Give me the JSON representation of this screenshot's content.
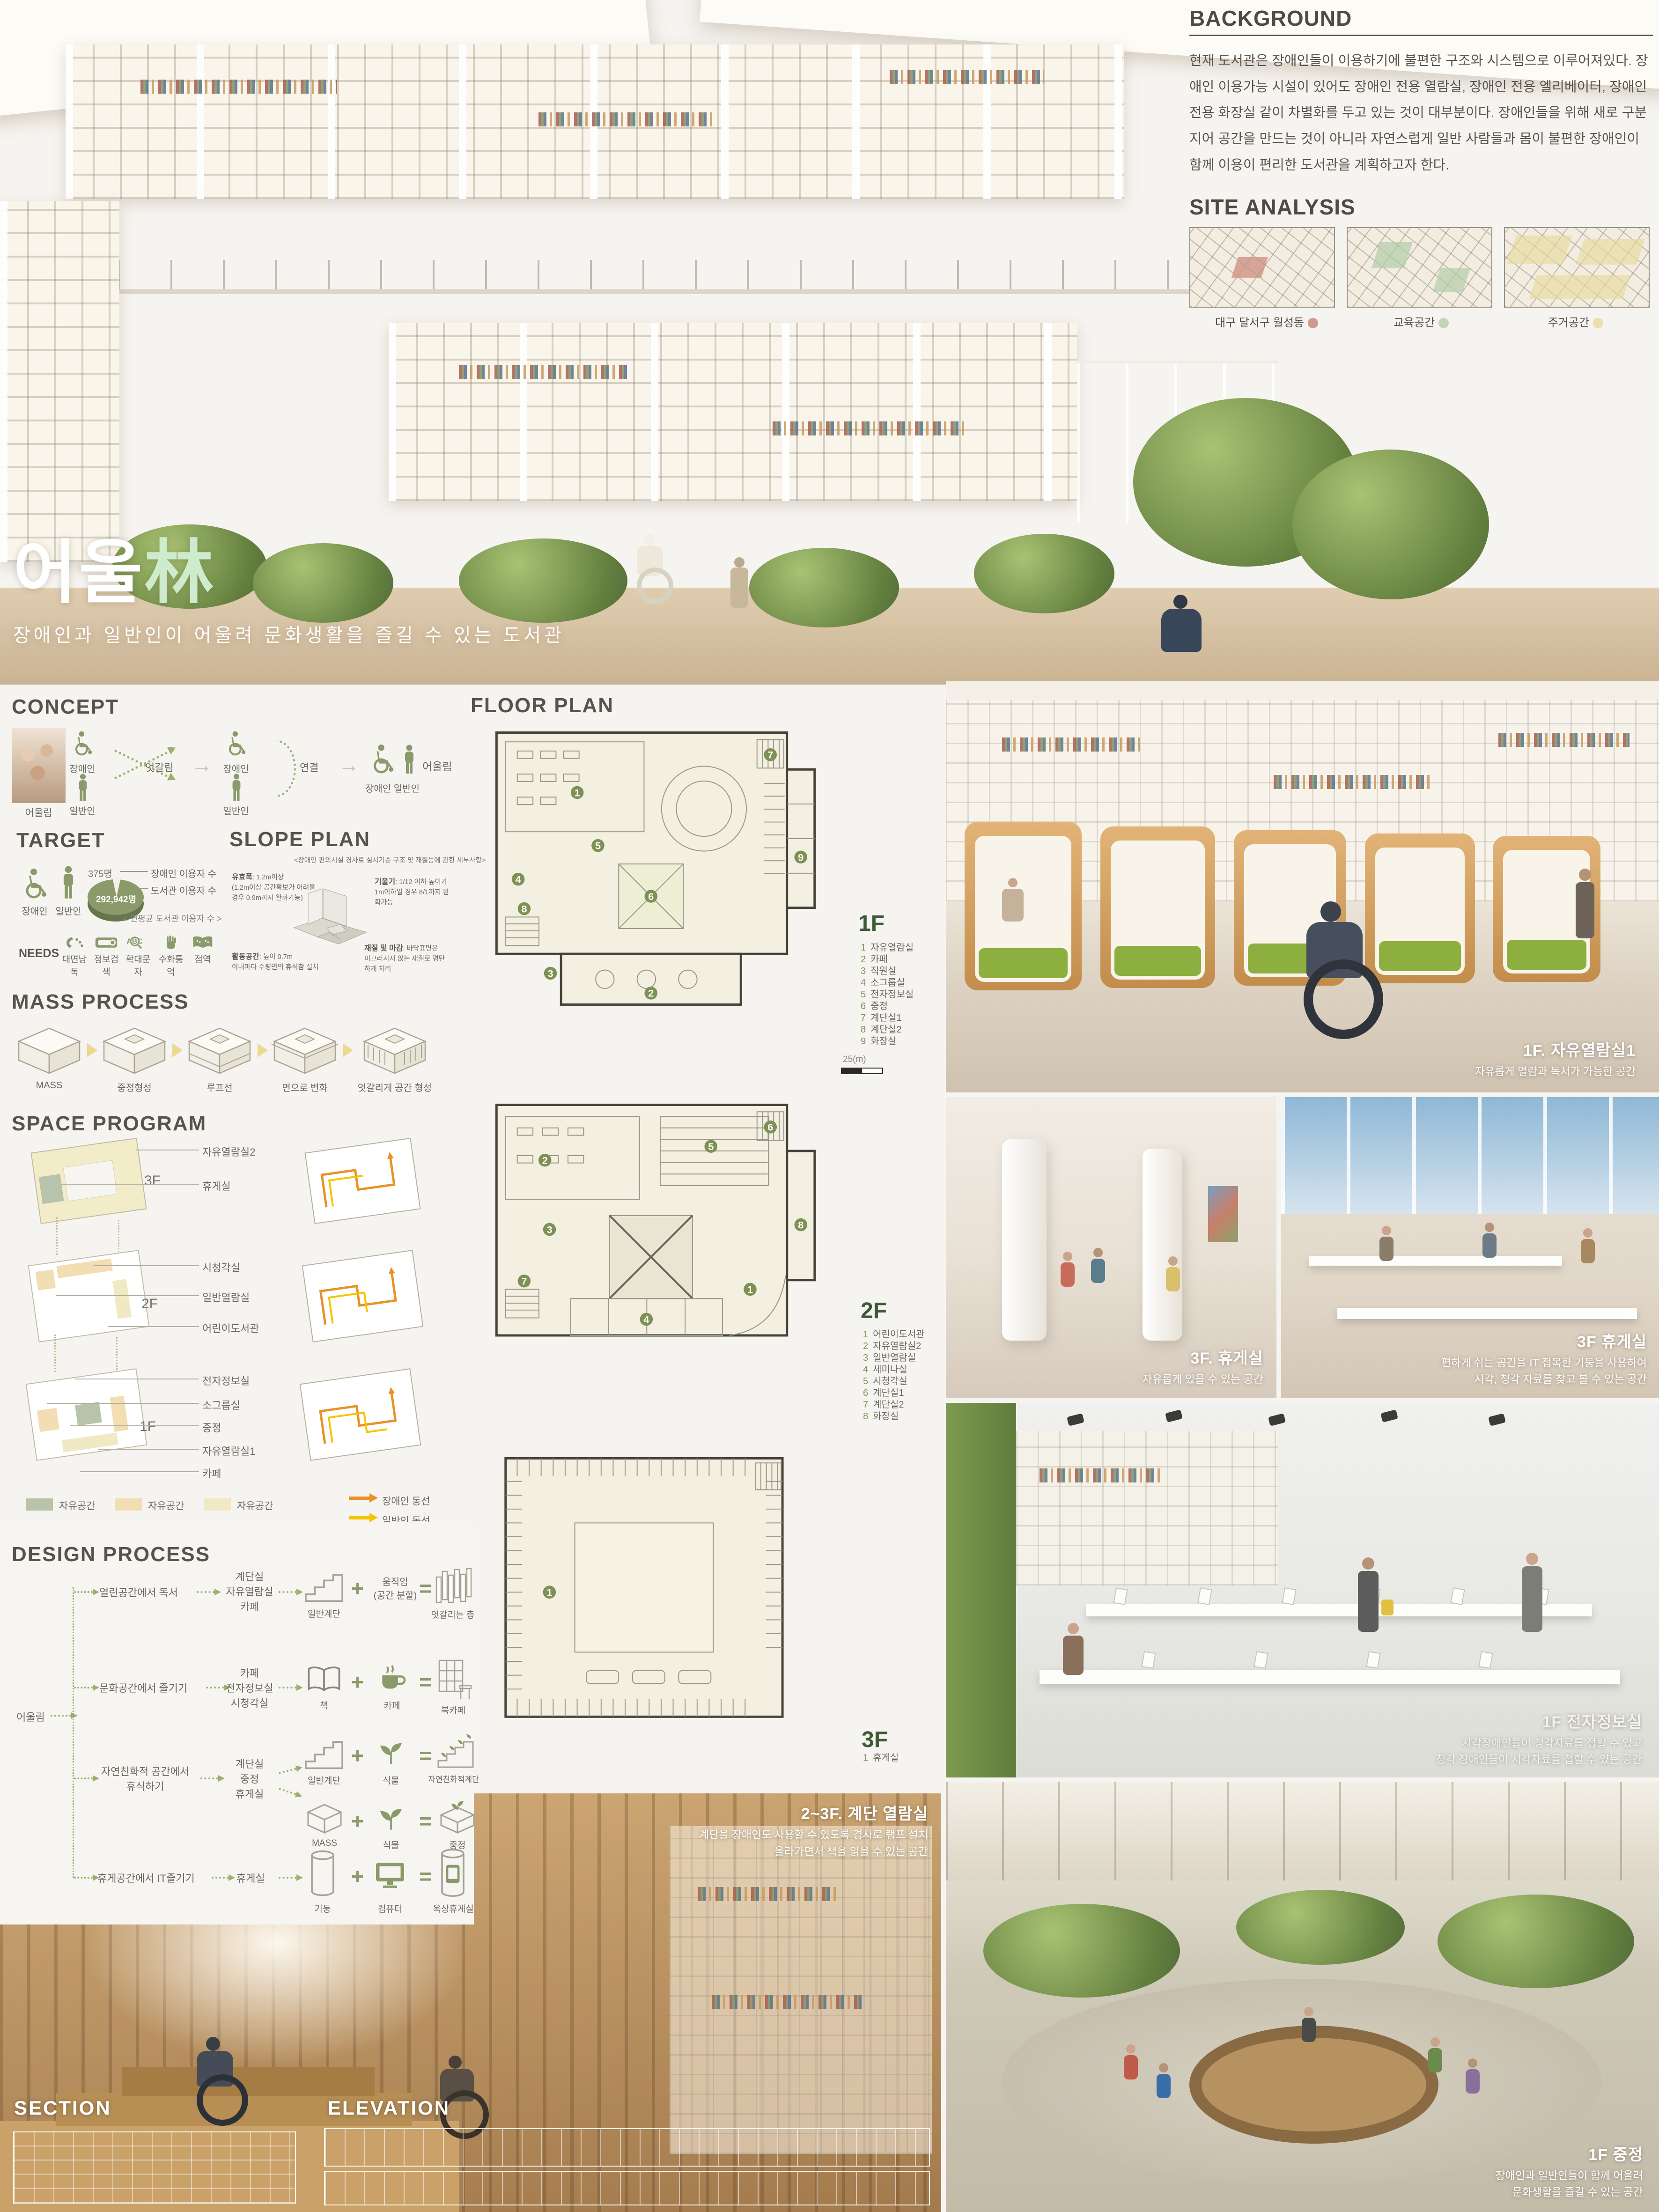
{
  "colors": {
    "accent_olive": "#8a9a6b",
    "title_green": "#cdeccd",
    "legend_green": "#b8c3ab",
    "legend_tan": "#f2deb2",
    "legend_yellow": "#f1e9c4",
    "circulation_disabled_orange": "#e8922a",
    "circulation_general_yellow": "#f5c400"
  },
  "hero": {
    "title_kr": "어울",
    "title_hanja": "林",
    "subtitle": "장애인과 일반인이 어울려 문화생활을 즐길 수 있는 도서관"
  },
  "background": {
    "heading": "BACKGROUND",
    "body": "현재 도서관은 장애인들이 이용하기에 불편한 구조와 시스템으로 이루어져있다. 장애인 이용가능 시설이 있어도 장애인 전용 열람실, 장애인 전용 엘리베이터, 장애인 전용 화장실 같이 차별화를 두고 있는 것이 대부분이다. 장애인들을 위해 새로 구분 지어 공간을 만드는 것이 아니라 자연스럽게 일반 사람들과 몸이 불편한 장애인이 함께 이용이 편리한 도서관을 계획하고자 한다."
  },
  "site_analysis": {
    "heading": "SITE ANALYSIS",
    "maps": [
      {
        "caption": "대구 달서구 월성동"
      },
      {
        "caption": "교육공간"
      },
      {
        "caption": "주거공간"
      }
    ]
  },
  "concept": {
    "heading": "CONCEPT",
    "photo_caption": "어울림",
    "disabled_label": "장애인",
    "general_label": "일반인",
    "cross_label": "엇갈림",
    "connect_label": "연결",
    "pair_label": "장애인  일반인",
    "result_label": "어울림"
  },
  "target": {
    "heading": "TARGET",
    "disabled_label": "장애인",
    "general_label": "일반인",
    "pie": {
      "small_value": "375명",
      "large_value": "292,942명",
      "small_label": "장애인 이용자 수",
      "large_label": "도서관 이용자 수",
      "caption": "< 연평균 도서관 이용자 수 >"
    },
    "needs_label": "NEEDS",
    "needs": [
      "대면낭독",
      "정보검색",
      "확대문자",
      "수화통역",
      "점역"
    ]
  },
  "slope_plan": {
    "heading": "SLOPE PLAN",
    "subtitle": "<장애인 편의시설 경사로 설치기준 구조 및 재질등에 관한 세부사항>",
    "notes": [
      {
        "title": "유효폭",
        "body": ": 1.2m이상\n(1.2m이상 공간확보가 어려울\n경우 0.9m까지 완화가능)"
      },
      {
        "title": "기울기",
        "body": ": 1/12 이하 높이가\n1m이하일 경우 8/1까지 완\n화가능"
      },
      {
        "title": "활동공간",
        "body": ": 높이 0.7m\n이내마다 수평면의 휴식참 설치"
      },
      {
        "title": "재질 및 마감",
        "body": ": 바닥표면은\n미끄러지지 않는 재질로 평탄\n하게 처리"
      }
    ]
  },
  "mass_process": {
    "heading": "MASS PROCESS",
    "steps": [
      "MASS",
      "중정형성",
      "루프선",
      "면으로 변화",
      "엇갈리게 공간 형성"
    ]
  },
  "space_program": {
    "heading": "SPACE PROGRAM",
    "floor_tags": [
      "3F",
      "2F",
      "1F"
    ],
    "labels_3f": [
      "자유열람실2",
      "휴게실"
    ],
    "labels_2f": [
      "시청각실",
      "일반열람실",
      "어린이도서관"
    ],
    "labels_1f": [
      "전자정보실",
      "소그룹실",
      "중정",
      "자유열람실1",
      "카페"
    ],
    "legend": [
      {
        "label": "자유공간"
      },
      {
        "label": "자유공간"
      },
      {
        "label": "자유공간"
      }
    ],
    "circulation": [
      {
        "label": "장애인 동선"
      },
      {
        "label": "일반인 동선"
      }
    ]
  },
  "design_process": {
    "heading": "DESIGN PROCESS",
    "root": "어울림",
    "rows": [
      {
        "activity": "열린공간에서 독서",
        "spaces": "계단실\n자유열람실\n카페",
        "a_label": "일반계단",
        "plus_label": "움직임\n(공간 분할)",
        "result_label": "엇갈리는 층"
      },
      {
        "activity": "문화공간에서 즐기기",
        "spaces": "카페\n전자정보실\n시청각실",
        "a_label": "책",
        "b_label": "카페",
        "result_label": "북카페"
      },
      {
        "activity": "자연친화적 공간에서\n휴식하기",
        "spaces": "계단실\n중정\n휴게실",
        "a_label": "일반계단",
        "b_label": "식물",
        "result_label": "자연친화적계단",
        "a2_label": "MASS",
        "b2_label": "식물",
        "result2_label": "중정"
      },
      {
        "activity": "휴게공간에서 IT즐기기",
        "spaces": "휴게실",
        "a_label": "기둥",
        "b_label": "컴퓨터",
        "result_label": "옥상휴게실"
      }
    ]
  },
  "floor_plan": {
    "heading": "FLOOR PLAN",
    "floors": [
      {
        "tag": "1F",
        "scale": "25(m)",
        "items": [
          {
            "num": "1",
            "label": "자유열람실"
          },
          {
            "num": "2",
            "label": "카페"
          },
          {
            "num": "3",
            "label": "직원실"
          },
          {
            "num": "4",
            "label": "소그룹실"
          },
          {
            "num": "5",
            "label": "전자정보실"
          },
          {
            "num": "6",
            "label": "중정"
          },
          {
            "num": "7",
            "label": "계단실1"
          },
          {
            "num": "8",
            "label": "계단실2"
          },
          {
            "num": "9",
            "label": "화장실"
          }
        ]
      },
      {
        "tag": "2F",
        "items": [
          {
            "num": "1",
            "label": "어린이도서관"
          },
          {
            "num": "2",
            "label": "자유열람실2"
          },
          {
            "num": "3",
            "label": "일반열람실"
          },
          {
            "num": "4",
            "label": "세미나실"
          },
          {
            "num": "5",
            "label": "시청각실"
          },
          {
            "num": "6",
            "label": "계단실1"
          },
          {
            "num": "7",
            "label": "계단실2"
          },
          {
            "num": "8",
            "label": "화장실"
          }
        ]
      },
      {
        "tag": "3F",
        "items": [
          {
            "num": "1",
            "label": "휴게실"
          }
        ]
      }
    ]
  },
  "renders": [
    {
      "title": "1F. 자유열람실1",
      "lines": "자유롭게 열람과 독서가 가능한 공간"
    },
    {
      "title": "3F. 휴게실",
      "lines": "자유롭게 있을 수 있는 공간"
    },
    {
      "title": "3F 휴게실",
      "lines": "편하게 쉬는 공간을 IT 접목한 기둥을 사용하여\n시각, 청각 자료를 찾고 볼 수 있는 공간"
    },
    {
      "title": "1F 전자정보실",
      "lines": "시각장애인들이 청각자료를 접할 수 있고\n청각 장애인들이 시각자료를 접할 수 있는 공간"
    },
    {
      "title": "2~3F. 계단 열람실",
      "lines": "계단을 장애인도 사용할 수 있도록 경사로 램프 설치\n올라가면서 책을 읽을 수 있는 공간"
    },
    {
      "title": "1F 중정",
      "lines": "장애인과 일반인들이 함께 어울려\n문화생활을 즐길 수 있는 공간"
    }
  ],
  "drawings": {
    "section_heading": "SECTION",
    "elevation_heading": "ELEVATION"
  }
}
